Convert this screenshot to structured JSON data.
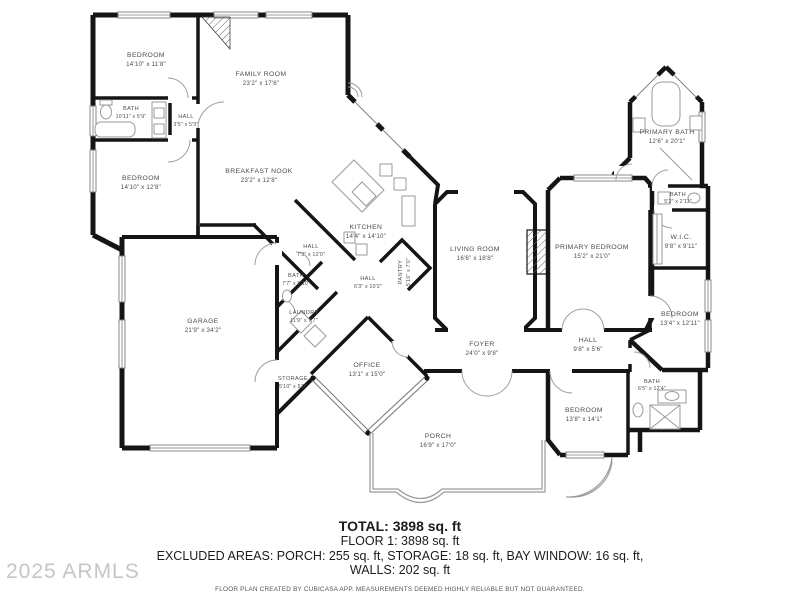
{
  "rooms": [
    {
      "label": "BEDROOM",
      "dims": "14'10\" x 11'8\""
    },
    {
      "label": "FAMILY ROOM",
      "dims": "23'2\" x 17'6\""
    },
    {
      "label": "BATH",
      "dims": "10'11\" x 5'9\""
    },
    {
      "label": "HALL",
      "dims": "3'5\" x 5'9\""
    },
    {
      "label": "BEDROOM",
      "dims": "14'10\" x 12'8\""
    },
    {
      "label": "BREAKFAST NOOK",
      "dims": "23'2\" x 12'8\""
    },
    {
      "label": "KITCHEN",
      "dims": "14'4\" x 14'10\""
    },
    {
      "label": "HALL",
      "dims": "7'3\" x 12'0\""
    },
    {
      "label": "BATH",
      "dims": "7'7\" x 5'10\""
    },
    {
      "label": "HALL",
      "dims": "6'3\" x 10'2\""
    },
    {
      "label": "PANTRY",
      "dims": "5'10\" x 7'0\""
    },
    {
      "label": "LIVING ROOM",
      "dims": "16'6\" x 18'8\""
    },
    {
      "label": "PRIMARY BEDROOM",
      "dims": "15'2\" x 21'0\""
    },
    {
      "label": "PRIMARY BATH",
      "dims": "12'6\" x 20'1\""
    },
    {
      "label": "BATH",
      "dims": "5'2\" x 2'11\""
    },
    {
      "label": "W.I.C.",
      "dims": "9'8\" x 9'11\""
    },
    {
      "label": "BEDROOM",
      "dims": "13'4\" x 12'11\""
    },
    {
      "label": "HALL",
      "dims": "9'8\" x 5'6\""
    },
    {
      "label": "BEDROOM",
      "dims": "13'8\" x 14'1\""
    },
    {
      "label": "BATH",
      "dims": "6'5\" x 12'4\""
    },
    {
      "label": "FOYER",
      "dims": "24'0\" x 9'8\""
    },
    {
      "label": "PORCH",
      "dims": "16'9\" x 17'0\""
    },
    {
      "label": "OFFICE",
      "dims": "13'1\" x 15'0\""
    },
    {
      "label": "STORAGE",
      "dims": "5'10\" x 5'9\""
    },
    {
      "label": "LAUNDRY",
      "dims": "11'9\" x 7'7\""
    },
    {
      "label": "GARAGE",
      "dims": "21'9\" x 34'2\""
    }
  ],
  "summary": {
    "total": "TOTAL: 3898 sq. ft",
    "floor": "FLOOR 1: 3898 sq. ft",
    "excluded": "EXCLUDED AREAS: PORCH: 255 sq. ft, STORAGE: 18 sq. ft, BAY WINDOW: 16 sq. ft,",
    "walls": "WALLS: 202 sq. ft",
    "disclaimer": "FLOOR PLAN CREATED BY CUBICASA APP. MEASUREMENTS DEEMED HIGHLY RELIABLE BUT NOT GUARANTEED."
  },
  "watermark": "2025 ARMLS"
}
